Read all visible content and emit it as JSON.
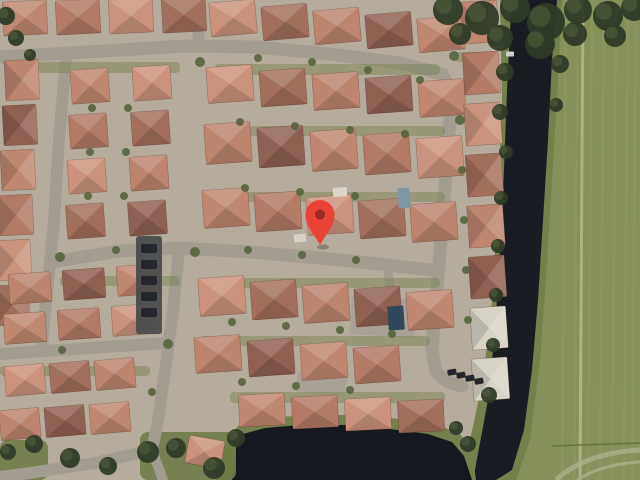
{
  "map": {
    "description": "Satellite aerial view of a suburban residential neighborhood with red tile roofs, a canal and grass field on the right, a pond at the bottom, and a red location pin marker near the center",
    "marker": {
      "x": 320,
      "y": 245,
      "balloon_cx": 320,
      "balloon_cy": 214.5,
      "balloon_r": 14.5,
      "color": "#E94335",
      "dot_color": "#962B22",
      "dot_r": 5
    },
    "palette": {
      "ground": "#b6ac9d",
      "street": "#a39d91",
      "field": "#85905a",
      "field_streak": "#9aa468",
      "field_path": "#b8bd8f",
      "fence": "#5a6540",
      "track": "#aab088",
      "bank": "#75814c",
      "grass": "#6f7b48",
      "water": "#191d23",
      "pond_water": "#15181e",
      "canopy": "#2e3a28",
      "shrub": "#55643d",
      "pad": "#a7a197",
      "car": "#23262a",
      "roofs": [
        "#c08872",
        "#b27a67",
        "#cb937e",
        "#a26f5e",
        "#bd8570",
        "#8f6152"
      ],
      "roof_light": "#d8d3c7",
      "alley": "#45484a"
    },
    "field_poly": [
      [
        553,
        0
      ],
      [
        640,
        0
      ],
      [
        640,
        480
      ],
      [
        510,
        480
      ],
      [
        525,
        430
      ],
      [
        536,
        360
      ],
      [
        544,
        270
      ],
      [
        549,
        180
      ],
      [
        552,
        90
      ]
    ],
    "field_streaks": [
      566,
      578,
      592,
      604,
      616,
      628,
      636
    ],
    "field_path_x": 583,
    "fence_line": [
      [
        552,
        446
      ],
      [
        640,
        443
      ]
    ],
    "track_arcs": [
      "M556,480 Q585,453 640,450",
      "M577,480 Q602,464 640,462"
    ],
    "bank_poly": [
      [
        500,
        0
      ],
      [
        562,
        0
      ],
      [
        558,
        80
      ],
      [
        552,
        180
      ],
      [
        546,
        280
      ],
      [
        540,
        360
      ],
      [
        530,
        440
      ],
      [
        516,
        480
      ],
      [
        462,
        480
      ],
      [
        470,
        440
      ],
      [
        483,
        380
      ],
      [
        492,
        300
      ],
      [
        498,
        200
      ],
      [
        502,
        100
      ]
    ],
    "canal_poly": [
      [
        512,
        0
      ],
      [
        557,
        0
      ],
      [
        552,
        60
      ],
      [
        548,
        140
      ],
      [
        543,
        220
      ],
      [
        538,
        300
      ],
      [
        532,
        370
      ],
      [
        524,
        430
      ],
      [
        512,
        470
      ],
      [
        496,
        480
      ],
      [
        473,
        480
      ],
      [
        479,
        448
      ],
      [
        488,
        400
      ],
      [
        495,
        330
      ],
      [
        500,
        250
      ],
      [
        504,
        170
      ],
      [
        507,
        90
      ],
      [
        510,
        30
      ]
    ],
    "pond_bank_poly": [
      [
        218,
        480
      ],
      [
        224,
        445
      ],
      [
        238,
        426
      ],
      [
        265,
        418
      ],
      [
        310,
        415
      ],
      [
        355,
        415
      ],
      [
        400,
        419
      ],
      [
        438,
        425
      ],
      [
        460,
        434
      ],
      [
        472,
        450
      ],
      [
        476,
        480
      ]
    ],
    "pond_poly": [
      [
        232,
        480
      ],
      [
        236,
        448
      ],
      [
        243,
        434
      ],
      [
        265,
        428
      ],
      [
        300,
        425
      ],
      [
        345,
        425
      ],
      [
        390,
        429
      ],
      [
        428,
        434
      ],
      [
        452,
        442
      ],
      [
        464,
        456
      ],
      [
        472,
        480
      ]
    ],
    "grass_patches": [
      [
        140,
        432,
        96,
        48
      ],
      [
        0,
        440,
        48,
        40
      ]
    ],
    "streets": [
      {
        "pts": [
          [
            0,
            57
          ],
          [
            120,
            50
          ],
          [
            185,
            46
          ],
          [
            255,
            47
          ],
          [
            330,
            54
          ],
          [
            400,
            63
          ],
          [
            442,
            74
          ],
          [
            452,
            92
          ]
        ],
        "w": 13
      },
      {
        "pts": [
          [
            198,
            0
          ],
          [
            199,
            45
          ]
        ],
        "w": 12
      },
      {
        "pts": [
          [
            66,
            56
          ],
          [
            59,
            140
          ],
          [
            54,
            220
          ],
          [
            50,
            262
          ],
          [
            46,
            300
          ],
          [
            42,
            348
          ]
        ],
        "w": 12
      },
      {
        "pts": [
          [
            57,
            261
          ],
          [
            120,
            251
          ],
          [
            180,
            248
          ],
          [
            250,
            252
          ],
          [
            320,
            258
          ],
          [
            380,
            264
          ],
          [
            438,
            271
          ]
        ],
        "w": 13
      },
      {
        "pts": [
          [
            452,
            92
          ],
          [
            447,
            160
          ],
          [
            441,
            240
          ],
          [
            436,
            300
          ],
          [
            432,
            350
          ],
          [
            436,
            372
          ],
          [
            448,
            382
          ],
          [
            462,
            386
          ]
        ],
        "w": 13
      },
      {
        "pts": [
          [
            0,
            354
          ],
          [
            60,
            350
          ],
          [
            120,
            346
          ],
          [
            166,
            343
          ]
        ],
        "w": 12
      },
      {
        "pts": [
          [
            179,
            250
          ],
          [
            173,
            310
          ],
          [
            166,
            365
          ],
          [
            158,
            420
          ],
          [
            152,
            450
          ]
        ],
        "w": 12
      },
      {
        "pts": [
          [
            152,
            450
          ],
          [
            95,
            463
          ],
          [
            30,
            473
          ],
          [
            0,
            477
          ]
        ],
        "w": 12
      },
      {
        "pts": [
          [
            152,
            450
          ],
          [
            163,
            480
          ]
        ],
        "w": 10
      },
      {
        "pts": [
          [
            388,
            270
          ],
          [
            392,
            308
          ]
        ],
        "w": 9
      }
    ],
    "pads": [
      [
        [
          352,
          296
        ],
        [
          418,
          300
        ],
        [
          414,
          338
        ],
        [
          350,
          334
        ]
      ],
      [
        [
          298,
          372
        ],
        [
          348,
          376
        ],
        [
          344,
          396
        ],
        [
          296,
          392
        ]
      ]
    ],
    "lawns": [
      [
        20,
        62,
        160,
        11
      ],
      [
        215,
        64,
        225,
        11
      ],
      [
        205,
        126,
        240,
        10
      ],
      [
        205,
        192,
        240,
        10
      ],
      [
        60,
        276,
        120,
        10
      ],
      [
        200,
        278,
        240,
        10
      ],
      [
        200,
        336,
        230,
        10
      ],
      [
        0,
        366,
        150,
        10
      ],
      [
        230,
        392,
        215,
        11
      ],
      [
        455,
        52,
        42,
        10
      ]
    ],
    "house_rows": [
      {
        "x": 25,
        "y": 18,
        "dx": 53,
        "dy": -1,
        "n": 4,
        "w": 44,
        "h": 34,
        "rot": -3
      },
      {
        "x": 233,
        "y": 18,
        "dx": 52,
        "dy": 4,
        "n": 5,
        "w": 46,
        "h": 34,
        "rot": -5
      },
      {
        "x": 22,
        "y": 80,
        "dx": -2,
        "dy": 45,
        "n": 6,
        "w": 40,
        "h": 34,
        "rot": 87
      },
      {
        "x": 90,
        "y": 86,
        "dx": -1.5,
        "dy": 45,
        "n": 4,
        "w": 38,
        "h": 34,
        "rot": -4
      },
      {
        "x": 152,
        "y": 83,
        "dx": -1.5,
        "dy": 45,
        "n": 4,
        "w": 38,
        "h": 34,
        "rot": -4
      },
      {
        "x": 30,
        "y": 288,
        "dx": 54,
        "dy": -4,
        "n": 3,
        "w": 42,
        "h": 30,
        "rot": -4
      },
      {
        "x": 25,
        "y": 328,
        "dx": 54,
        "dy": -4,
        "n": 3,
        "w": 42,
        "h": 30,
        "rot": -4
      },
      {
        "x": 230,
        "y": 84,
        "dx": 53,
        "dy": 3.5,
        "n": 5,
        "w": 46,
        "h": 36,
        "rot": -4
      },
      {
        "x": 228,
        "y": 143,
        "dx": 53,
        "dy": 3.5,
        "n": 5,
        "w": 46,
        "h": 40,
        "rot": -4
      },
      {
        "x": 226,
        "y": 208,
        "dx": 52,
        "dy": 3.5,
        "n": 5,
        "w": 46,
        "h": 38,
        "rot": -4
      },
      {
        "x": 222,
        "y": 296,
        "dx": 52,
        "dy": 3.5,
        "n": 5,
        "w": 46,
        "h": 38,
        "rot": -4
      },
      {
        "x": 218,
        "y": 354,
        "dx": 53,
        "dy": 3.5,
        "n": 4,
        "w": 46,
        "h": 36,
        "rot": -4
      },
      {
        "x": 262,
        "y": 410,
        "dx": 53,
        "dy": 2,
        "n": 4,
        "w": 46,
        "h": 32,
        "rot": -3
      },
      {
        "x": 25,
        "y": 380,
        "dx": 45,
        "dy": -3,
        "n": 3,
        "w": 40,
        "h": 30,
        "rot": -5
      },
      {
        "x": 20,
        "y": 424,
        "dx": 45,
        "dy": -3,
        "n": 3,
        "w": 40,
        "h": 30,
        "rot": -5
      },
      {
        "x": 480,
        "y": 22,
        "dx": 1.5,
        "dy": 51,
        "n": 8,
        "w": 42,
        "h": 36,
        "rot": 86,
        "light": [
          6,
          7
        ]
      },
      {
        "x": 205,
        "y": 452,
        "dx": 0,
        "dy": 0,
        "n": 1,
        "w": 36,
        "h": 28,
        "rot": 10
      }
    ],
    "alley": {
      "x": 136,
      "y": 236,
      "w": 26,
      "h": 98
    },
    "alley_cars": [
      [
        141,
        244
      ],
      [
        141,
        260
      ],
      [
        141,
        276
      ],
      [
        141,
        292
      ],
      [
        141,
        308
      ]
    ],
    "parking_cars": [
      [
        447,
        370
      ],
      [
        456,
        373
      ],
      [
        465,
        376
      ],
      [
        474,
        379
      ]
    ],
    "details": [
      {
        "x": 404,
        "y": 198,
        "w": 12,
        "h": 20,
        "c": "#7d96a6",
        "rot": -4
      },
      {
        "x": 340,
        "y": 192,
        "w": 14,
        "h": 9,
        "c": "#dad6cc",
        "rot": -4
      },
      {
        "x": 396,
        "y": 318,
        "w": 16,
        "h": 24,
        "c": "#31485a",
        "rot": -4
      },
      {
        "x": 300,
        "y": 238,
        "w": 12,
        "h": 8,
        "c": "#d6d2c8",
        "rot": -4
      },
      {
        "x": 498,
        "y": 48,
        "w": 10,
        "h": 5,
        "c": "#d9d9d2",
        "rot": 0
      },
      {
        "x": 510,
        "y": 54,
        "w": 8,
        "h": 5,
        "c": "#cfcfc8",
        "rot": 0
      }
    ],
    "canopy_trees": [
      [
        448,
        10,
        15
      ],
      [
        482,
        18,
        17
      ],
      [
        515,
        8,
        15
      ],
      [
        546,
        22,
        19
      ],
      [
        578,
        10,
        14
      ],
      [
        608,
        16,
        15
      ],
      [
        634,
        8,
        13
      ],
      [
        500,
        38,
        13
      ],
      [
        540,
        44,
        15
      ],
      [
        575,
        34,
        12
      ],
      [
        615,
        36,
        11
      ],
      [
        460,
        34,
        11
      ],
      [
        505,
        72,
        9
      ],
      [
        500,
        112,
        8
      ],
      [
        506,
        152,
        7
      ],
      [
        501,
        198,
        7
      ],
      [
        498,
        246,
        7
      ],
      [
        496,
        295,
        7
      ],
      [
        493,
        345,
        7
      ],
      [
        489,
        395,
        8
      ],
      [
        560,
        64,
        9
      ],
      [
        556,
        105,
        7
      ],
      [
        236,
        438,
        9
      ],
      [
        214,
        468,
        11
      ],
      [
        176,
        448,
        10
      ],
      [
        148,
        452,
        11
      ],
      [
        456,
        428,
        7
      ],
      [
        468,
        444,
        8
      ],
      [
        34,
        444,
        9
      ],
      [
        70,
        458,
        10
      ],
      [
        108,
        466,
        9
      ],
      [
        8,
        452,
        8
      ],
      [
        6,
        16,
        9
      ],
      [
        16,
        38,
        8
      ],
      [
        30,
        55,
        6
      ]
    ],
    "shrub_trees": [
      [
        200,
        62,
        5
      ],
      [
        258,
        58,
        4
      ],
      [
        312,
        62,
        4
      ],
      [
        368,
        70,
        4
      ],
      [
        420,
        80,
        4
      ],
      [
        195,
        252,
        5
      ],
      [
        248,
        250,
        4
      ],
      [
        302,
        255,
        4
      ],
      [
        356,
        260,
        4
      ],
      [
        60,
        257,
        5
      ],
      [
        116,
        250,
        4
      ],
      [
        168,
        344,
        5
      ],
      [
        62,
        350,
        4
      ],
      [
        240,
        122,
        4
      ],
      [
        295,
        126,
        4
      ],
      [
        350,
        130,
        4
      ],
      [
        405,
        134,
        4
      ],
      [
        245,
        188,
        4
      ],
      [
        300,
        192,
        4
      ],
      [
        355,
        196,
        4
      ],
      [
        232,
        322,
        4
      ],
      [
        286,
        326,
        4
      ],
      [
        340,
        330,
        4
      ],
      [
        392,
        334,
        4
      ],
      [
        242,
        382,
        4
      ],
      [
        296,
        386,
        4
      ],
      [
        350,
        390,
        4
      ],
      [
        152,
        392,
        4
      ],
      [
        92,
        108,
        4
      ],
      [
        90,
        152,
        4
      ],
      [
        88,
        196,
        4
      ],
      [
        128,
        108,
        4
      ],
      [
        126,
        152,
        4
      ],
      [
        124,
        196,
        4
      ],
      [
        460,
        120,
        5
      ],
      [
        462,
        170,
        4
      ],
      [
        464,
        220,
        4
      ],
      [
        466,
        270,
        4
      ],
      [
        468,
        320,
        4
      ],
      [
        454,
        56,
        5
      ]
    ]
  }
}
